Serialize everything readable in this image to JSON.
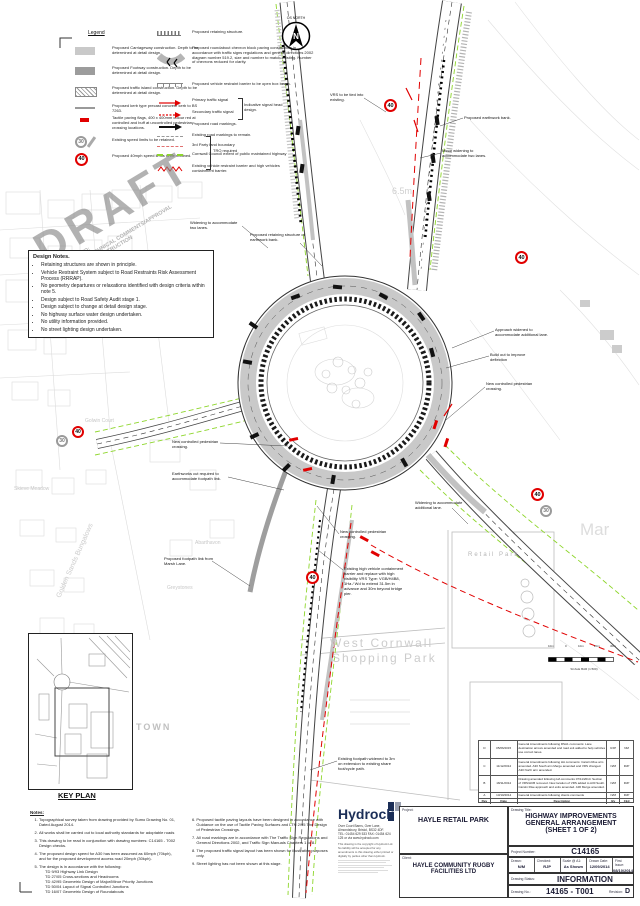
{
  "colors": {
    "accent_red": "#e10000",
    "council_green": "#8ed62c",
    "hydrock_navy": "#1b2e57",
    "draft_gray": "#8a8a8a",
    "carriageway_gray": "#c9c9c9",
    "footway_gray": "#9c9c9c"
  },
  "north_arrow": {
    "label": "OS NORTH",
    "letter": "N"
  },
  "watermark": {
    "big": "DRAFT",
    "line1": "SUBJECT TO:",
    "line2": "HIGHWAY TECHNICAL COMMENTS/APPROVAL",
    "line3": "NOT FOR CONSTRUCTION"
  },
  "legend": {
    "title": "Legend",
    "badge30": "30",
    "badge40": "40",
    "left": [
      "Proposed Carriageway construction. Depth to be determined at detail design.",
      "Proposed Footway construction. Depth to be determined at detail design.",
      "Proposed traffic island construction. Depth to be determined at detail design.",
      "Proposed kerb type precast concrete kerb to BS 7263.",
      "Tactile paving flags, 400 x 400mm colour red at controlled and buff at uncontrolled pedestrian crossing locations.",
      "Existing speed limits to be retained.",
      "Proposed 40mph speed limits to be retained."
    ],
    "tro_bracket": "TRO required",
    "right": [
      "Proposed retaining structure.",
      "Proposed roundabout chevron block paving construction in accordance with traffic signs regulations and general directions 2002 diagram number 519.2, size and number to match existing. Number of chevrons reduced for clarity.",
      "Proposed vehicle restraint barrier to be open box beam.",
      "Primary traffic signal",
      "Secondary traffic signal",
      "Proposed road markings.",
      "Existing road markings to remain.",
      "3rd Party land boundary",
      "Cornwall Council extent of public maintained highway",
      "Existing vehicle restraint barrier and high vehicles containment barrier."
    ],
    "signal_bracket": "Indicative signal head design."
  },
  "design_notes": {
    "title": "Design Notes.",
    "items": [
      "Retaining structures are shown in principle.",
      "Vehicle Restraint System subject to Road Restraints Risk Assessment Process (RRRAP).",
      "No geometry departures or relaxations identified with design criteria within note 5.",
      "Design subject to Road Safety Audit stage 1.",
      "Design subject to change at detail design stage.",
      "No highway surface water design undertaken.",
      "No utility information provided.",
      "No street lighting design undertaken."
    ]
  },
  "plan": {
    "annotations": [
      "VRS to be tied into existing.",
      "Proposed earthwork bank.",
      "Minor widening to accommodate two lanes.",
      "Widening to accommodate two lanes.",
      "Proposed retaining structure of earthwork bank.",
      "Approach widened to accommodate additional lane.",
      "Build out to improve deflection",
      "New controlled pedestrian crossing.",
      "New controlled pedestrian crossing.",
      "Earthworks cut required to accommodate footpath link.",
      "Proposed footpath link from Marsh Lane.",
      "Widening to accommodate additional lane.",
      "New controlled pedestrian crossing.",
      "Existing high vehicle containment barrier and replace with high visibility VRS Type: VGB/H4B8, 1Ha / Wd to extend 31.5m in advance and 30m beyond bridge pier.",
      "Existing footpath widened to 3m on extension to existing share foot/cycle path."
    ],
    "badges": [
      {
        "value": "40"
      },
      {
        "value": "40"
      },
      {
        "value": "40"
      },
      {
        "value": "30"
      },
      {
        "value": "40"
      },
      {
        "value": "40"
      },
      {
        "value": "30"
      }
    ],
    "map_labels": {
      "height_marker": "6.5m",
      "retail_park": "Retail Park",
      "shopping1": "West Cornwall",
      "shopping2": "Shopping Park",
      "town": "TOWN",
      "mar": "Mar",
      "abarthavon": "Abarthavon",
      "greystones": "Greystones",
      "golden_sands": "Golden Sands Bungalows",
      "skieve": "Skieve Meadow",
      "golwin": "Golwin Court"
    },
    "scale_bar": {
      "labels": [
        "10m",
        "0",
        "10m",
        "20m",
        "30m"
      ],
      "caption": "SCALE BAR (1:500)"
    }
  },
  "key_plan": {
    "label": "KEY PLAN"
  },
  "notes": {
    "title": "Notes:",
    "col1": [
      "Topographical survey taken from drawing provided by Sumo Drawing No. 01, Dated August 2014.",
      "All works shall be carried out to local authority standards for adoptable roads",
      "This drawing to be read in conjunction with drawing numbers: C14165 - T002  Design checks.",
      "The proposed design speed for A30 has been assumed as 60mph (70kph), and for the proposed development access road 20mph (30kph).",
      "The design is in accordance with the following:"
    ],
    "sub5": [
      "TD 9/93 Highway Link Design",
      "TD 27/05 Cross-sections and Headrooms",
      "TD 42/95 Geometric Design of Major/Minor Priority Junctions",
      "TD 50/04 Layout of Signal Controlled Junctions",
      "TD 16/07 Geometric Design of Roundabouts"
    ],
    "col2": [
      "Proposed tactile paving layouts have been designed in accordance with Guidance on the use of Tactile Paving Surfaces and LTN 2/95 The Design of Pedestrian Crossings.",
      "All road markings are in accordance with The Traffic Sign Regulations and General Directions 2002, and Traffic Sign Manuals Chapters 1 to 8.",
      "The proposed traffic signal layout has been shown for illustrative purposes only.",
      "Street lighting has not been shown at this stage."
    ]
  },
  "hydrock": {
    "name": "Hydrock",
    "address1": "Over Court Barns, Over Lane, Almondsbury, Bristol, BS32 4DF.",
    "address2": "TEL: 01454 629 533 FAX: 01454 624 125 or via www.hydrock.com",
    "copyright": "This drawing is the copyright of Hydrock Ltd. No liability will be accepted for any amendments to this drawing either printed or digitally by parties other than Hydrock."
  },
  "title_block": {
    "project_label": "Project:",
    "project": "HAYLE RETAIL PARK",
    "client_label": "Client:",
    "client": "HAYLE COMMUNITY RUGBY FACILITIES LTD",
    "drawing_title_label": "Drawing Title:",
    "drawing_title1": "HIGHWAY IMPROVEMENTS",
    "drawing_title2": "GENERAL ARRANGEMENT",
    "drawing_title3": "(SHEET 1 OF 2)",
    "project_number_label": "Project Number:",
    "project_number": "C14165",
    "drawn_label": "Drawn:",
    "drawn": "N/M",
    "checked_label": "Checked:",
    "checked": "RJP",
    "scale_label": "Scale @ A1:",
    "scale": "As Shown",
    "drawn_date_label": "Drawn Date:",
    "drawn_date": "12/09/2014",
    "first_issue_label": "First Issue:",
    "first_issue": "08/10/2014",
    "status_label": "Drawing Status:",
    "status": "INFORMATION",
    "number_label": "Drawing No.:",
    "number": "14165 - T001",
    "revision_label": "Revision:",
    "revision": "D"
  },
  "revision_table": {
    "headers": [
      "Rev",
      "Date",
      "Description",
      "By",
      "Ckd"
    ],
    "rows": [
      {
        "rev": "D",
        "date": "05/06/2015",
        "desc": "General Amendments following RSA1 comments: Lane destination arrows amended and road exit added to help vehicles use correct lanes.",
        "by": "RJP",
        "ckd": "NM"
      },
      {
        "rev": "C",
        "date": "11/12/2014",
        "desc": "General Amendments following HA comments: Carwin Rise arm amended. A30 South arm Merge amended and VRS changed. A30 North arm amended.",
        "by": "N/M",
        "ckd": "RJP"
      },
      {
        "rev": "B",
        "date": "18/11/2014",
        "desc": "Drawing amended following HA comments 07/11/2014: Section of VRS/HCB removed. New location of VRS added to A30 South. Carwin Rise approach and exits amended. A30 Merge amended.",
        "by": "N/M",
        "ckd": "RJP"
      },
      {
        "rev": "A",
        "date": "13/10/2014",
        "desc": "General Amendments following clients comments",
        "by": "N/M",
        "ckd": "RJP"
      }
    ]
  }
}
